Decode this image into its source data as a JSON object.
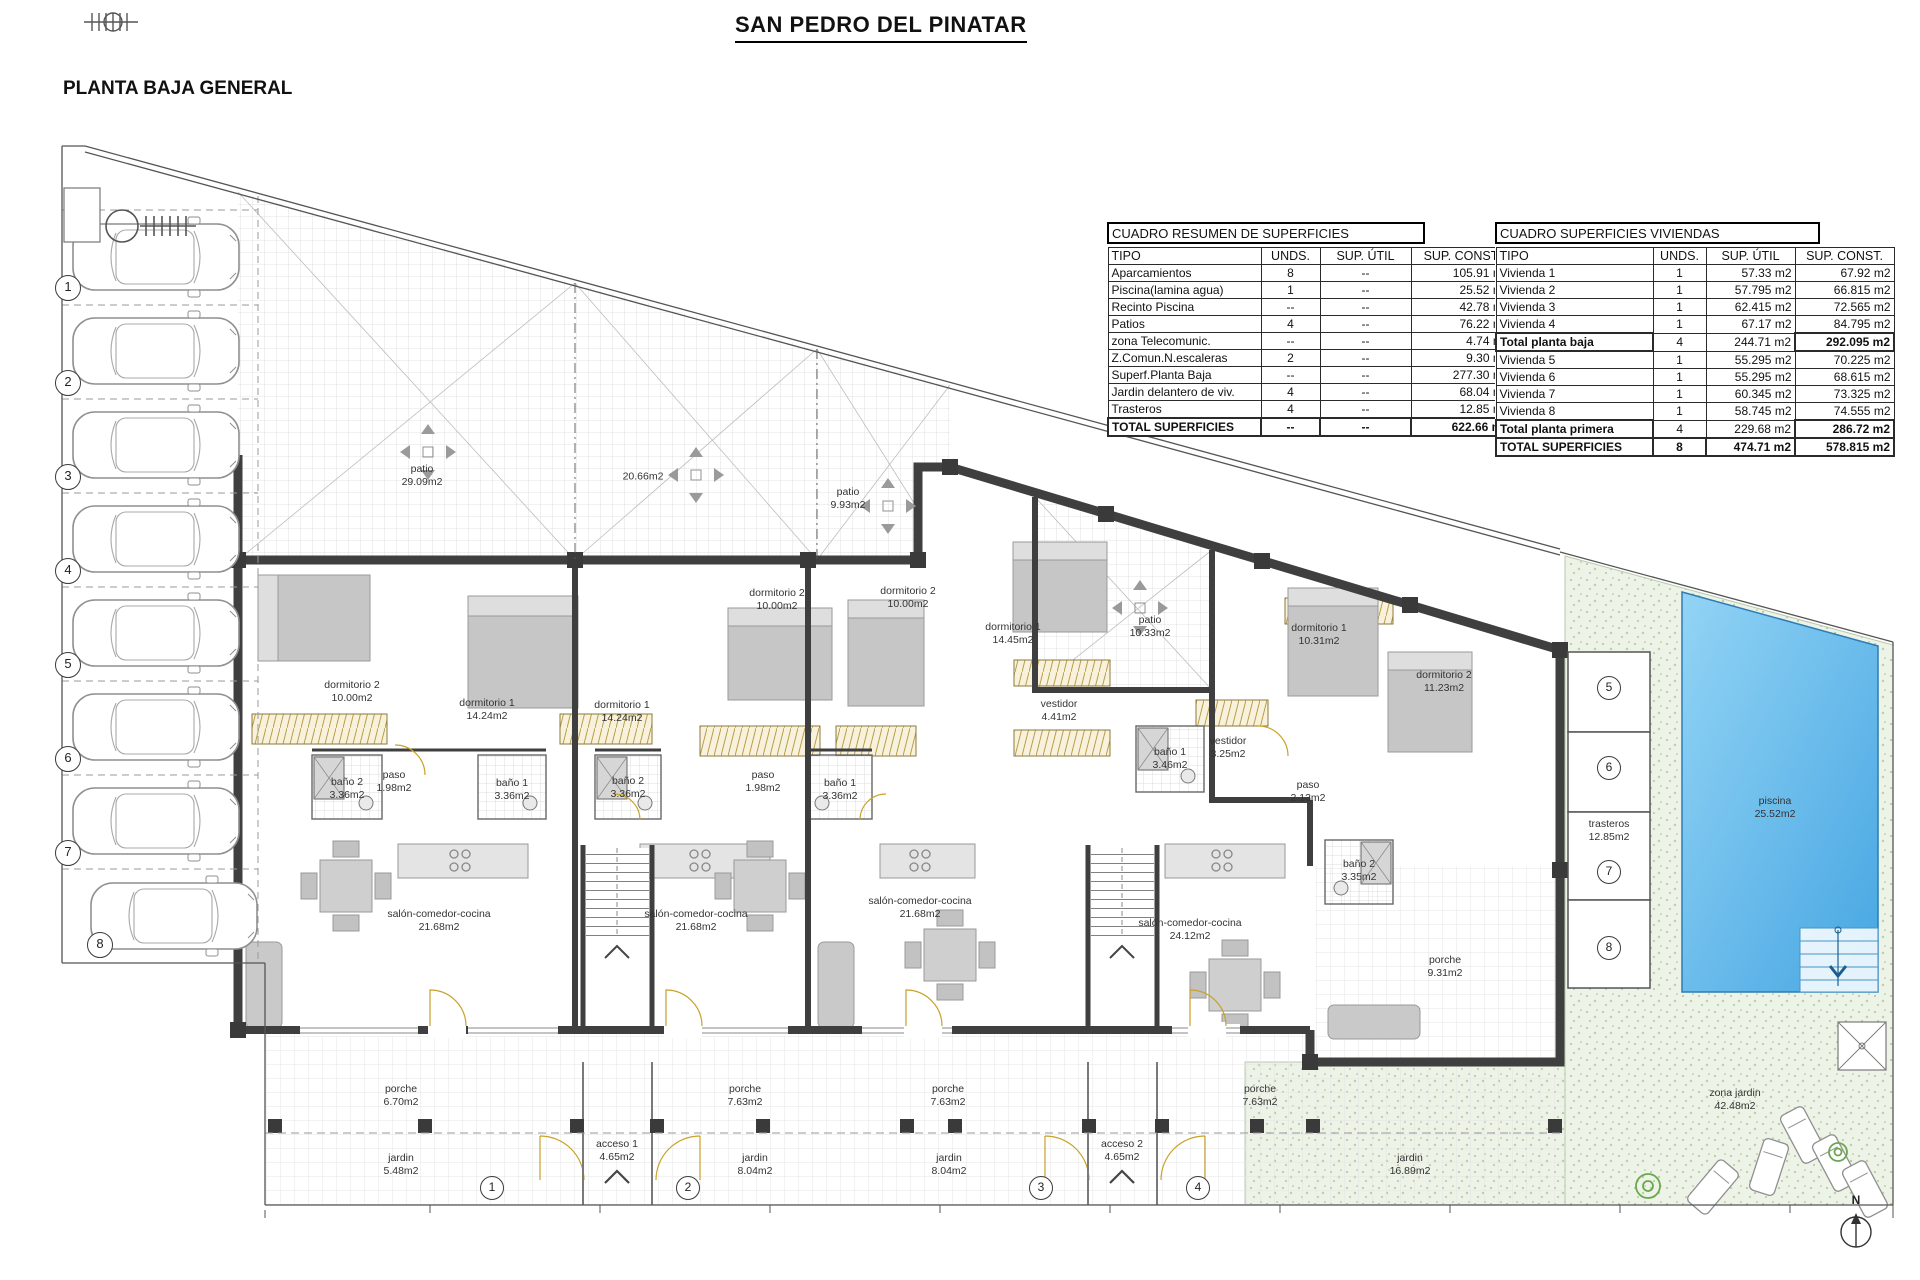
{
  "page": {
    "title": "SAN PEDRO DEL PINATAR",
    "subtitle": "PLANTA BAJA GENERAL"
  },
  "tables": {
    "resumen": {
      "title": "CUADRO RESUMEN DE SUPERFICIES",
      "headers": {
        "tipo": "TIPO",
        "unds": "UNDS.",
        "util": "SUP. ÚTIL",
        "const": "SUP. CONST."
      },
      "rows": [
        {
          "tipo": "Aparcamientos",
          "unds": "8",
          "util": "--",
          "const": "105.91 m2"
        },
        {
          "tipo": "Piscina(lamina agua)",
          "unds": "1",
          "util": "--",
          "const": "25.52 m2"
        },
        {
          "tipo": "Recinto Piscina",
          "unds": "--",
          "util": "--",
          "const": "42.78 m2"
        },
        {
          "tipo": "Patios",
          "unds": "4",
          "util": "--",
          "const": "76.22 m2"
        },
        {
          "tipo": "zona Telecomunic.",
          "unds": "--",
          "util": "--",
          "const": "4.74 m2"
        },
        {
          "tipo": "Z.Comun.N.escaleras",
          "unds": "2",
          "util": "--",
          "const": "9.30 m2"
        },
        {
          "tipo": "Superf.Planta Baja",
          "unds": "--",
          "util": "--",
          "const": "277.30 m2"
        },
        {
          "tipo": "Jardin delantero de viv.",
          "unds": "4",
          "util": "--",
          "const": "68.04 m2"
        },
        {
          "tipo": "Trasteros",
          "unds": "4",
          "util": "--",
          "const": "12.85 m2"
        }
      ],
      "total": {
        "tipo": "TOTAL SUPERFICIES",
        "unds": "--",
        "util": "--",
        "const": "622.66 m2"
      }
    },
    "viviendas": {
      "title": "CUADRO SUPERFICIES VIVIENDAS",
      "headers": {
        "tipo": "TIPO",
        "unds": "UNDS.",
        "util": "SUP. ÚTIL",
        "const": "SUP. CONST."
      },
      "rows": [
        {
          "tipo": "Vivienda 1",
          "unds": "1",
          "util": "57.33 m2",
          "const": "67.92 m2"
        },
        {
          "tipo": "Vivienda 2",
          "unds": "1",
          "util": "57.795 m2",
          "const": "66.815 m2"
        },
        {
          "tipo": "Vivienda 3",
          "unds": "1",
          "util": "62.415 m2",
          "const": "72.565 m2"
        },
        {
          "tipo": "Vivienda 4",
          "unds": "1",
          "util": "67.17 m2",
          "const": "84.795 m2"
        },
        {
          "tipo": "Total planta baja",
          "unds": "4",
          "util": "244.71 m2",
          "const": "292.095 m2"
        },
        {
          "tipo": "Vivienda 5",
          "unds": "1",
          "util": "55.295 m2",
          "const": "70.225 m2"
        },
        {
          "tipo": "Vivienda 6",
          "unds": "1",
          "util": "55.295 m2",
          "const": "68.615 m2"
        },
        {
          "tipo": "Vivienda 7",
          "unds": "1",
          "util": "60.345 m2",
          "const": "73.325 m2"
        },
        {
          "tipo": "Vivienda 8",
          "unds": "1",
          "util": "58.745 m2",
          "const": "74.555 m2"
        },
        {
          "tipo": "Total planta primera",
          "unds": "4",
          "util": "229.68 m2",
          "const": "286.72 m2"
        }
      ],
      "total": {
        "tipo": "TOTAL SUPERFICIES",
        "unds": "8",
        "util": "474.71 m2",
        "const": "578.815 m2"
      }
    }
  },
  "plan": {
    "north_label": "N",
    "parking_spaces": [
      "1",
      "2",
      "3",
      "4",
      "5",
      "6",
      "7",
      "8"
    ],
    "access_numbers": [
      "1",
      "2",
      "3",
      "4"
    ],
    "storage_numbers": [
      "5",
      "6",
      "7",
      "8"
    ],
    "colors": {
      "wall": "#3f3f3f",
      "pool": "#4aa8e0",
      "garden": "#edf3e6",
      "wardrobe": "#f8f2dd"
    },
    "rooms": [
      {
        "name": "patio",
        "area": "29.09m2"
      },
      {
        "name": "",
        "area": "20.66m2"
      },
      {
        "name": "patio",
        "area": "9.93m2"
      },
      {
        "name": "patio",
        "area": "10.33m2"
      },
      {
        "name": "dormitorio 2",
        "area": "10.00m2"
      },
      {
        "name": "dormitorio 1",
        "area": "14.24m2"
      },
      {
        "name": "dormitorio 1",
        "area": "14.24m2"
      },
      {
        "name": "dormitorio 2",
        "area": "10.00m2"
      },
      {
        "name": "dormitorio 2",
        "area": "10.00m2"
      },
      {
        "name": "dormitorio 1",
        "area": "14.45m2"
      },
      {
        "name": "dormitorio 1",
        "area": "10.31m2"
      },
      {
        "name": "dormitorio 2",
        "area": "11.23m2"
      },
      {
        "name": "vestidor",
        "area": "4.41m2"
      },
      {
        "name": "vestidor",
        "area": "3.25m2"
      },
      {
        "name": "baño 2",
        "area": "3.36m2"
      },
      {
        "name": "paso",
        "area": "1.98m2"
      },
      {
        "name": "baño 1",
        "area": "3.36m2"
      },
      {
        "name": "baño 2",
        "area": "3.36m2"
      },
      {
        "name": "paso",
        "area": "1.98m2"
      },
      {
        "name": "baño 1",
        "area": "3.36m2"
      },
      {
        "name": "baño 1",
        "area": "3.46m2"
      },
      {
        "name": "baño 2",
        "area": "3.35m2"
      },
      {
        "name": "paso",
        "area": "2.13m2"
      },
      {
        "name": "salón-comedor-cocina",
        "area": "21.68m2"
      },
      {
        "name": "salón-comedor-cocina",
        "area": "21.68m2"
      },
      {
        "name": "salón-comedor-cocina",
        "area": "21.68m2"
      },
      {
        "name": "salón-comedor-cocina",
        "area": "24.12m2"
      },
      {
        "name": "porche",
        "area": "9.31m2"
      },
      {
        "name": "trasteros",
        "area": "12.85m2"
      },
      {
        "name": "piscina",
        "area": "25.52m2"
      },
      {
        "name": "zona jardin",
        "area": "42.48m2"
      },
      {
        "name": "porche",
        "area": "6.70m2"
      },
      {
        "name": "jardin",
        "area": "5.48m2"
      },
      {
        "name": "acceso 1",
        "area": "4.65m2"
      },
      {
        "name": "porche",
        "area": "7.63m2"
      },
      {
        "name": "jardin",
        "area": "8.04m2"
      },
      {
        "name": "porche",
        "area": "7.63m2"
      },
      {
        "name": "jardin",
        "area": "8.04m2"
      },
      {
        "name": "acceso 2",
        "area": "4.65m2"
      },
      {
        "name": "porche",
        "area": "7.63m2"
      },
      {
        "name": "jardin",
        "area": "16.89m2"
      }
    ]
  }
}
